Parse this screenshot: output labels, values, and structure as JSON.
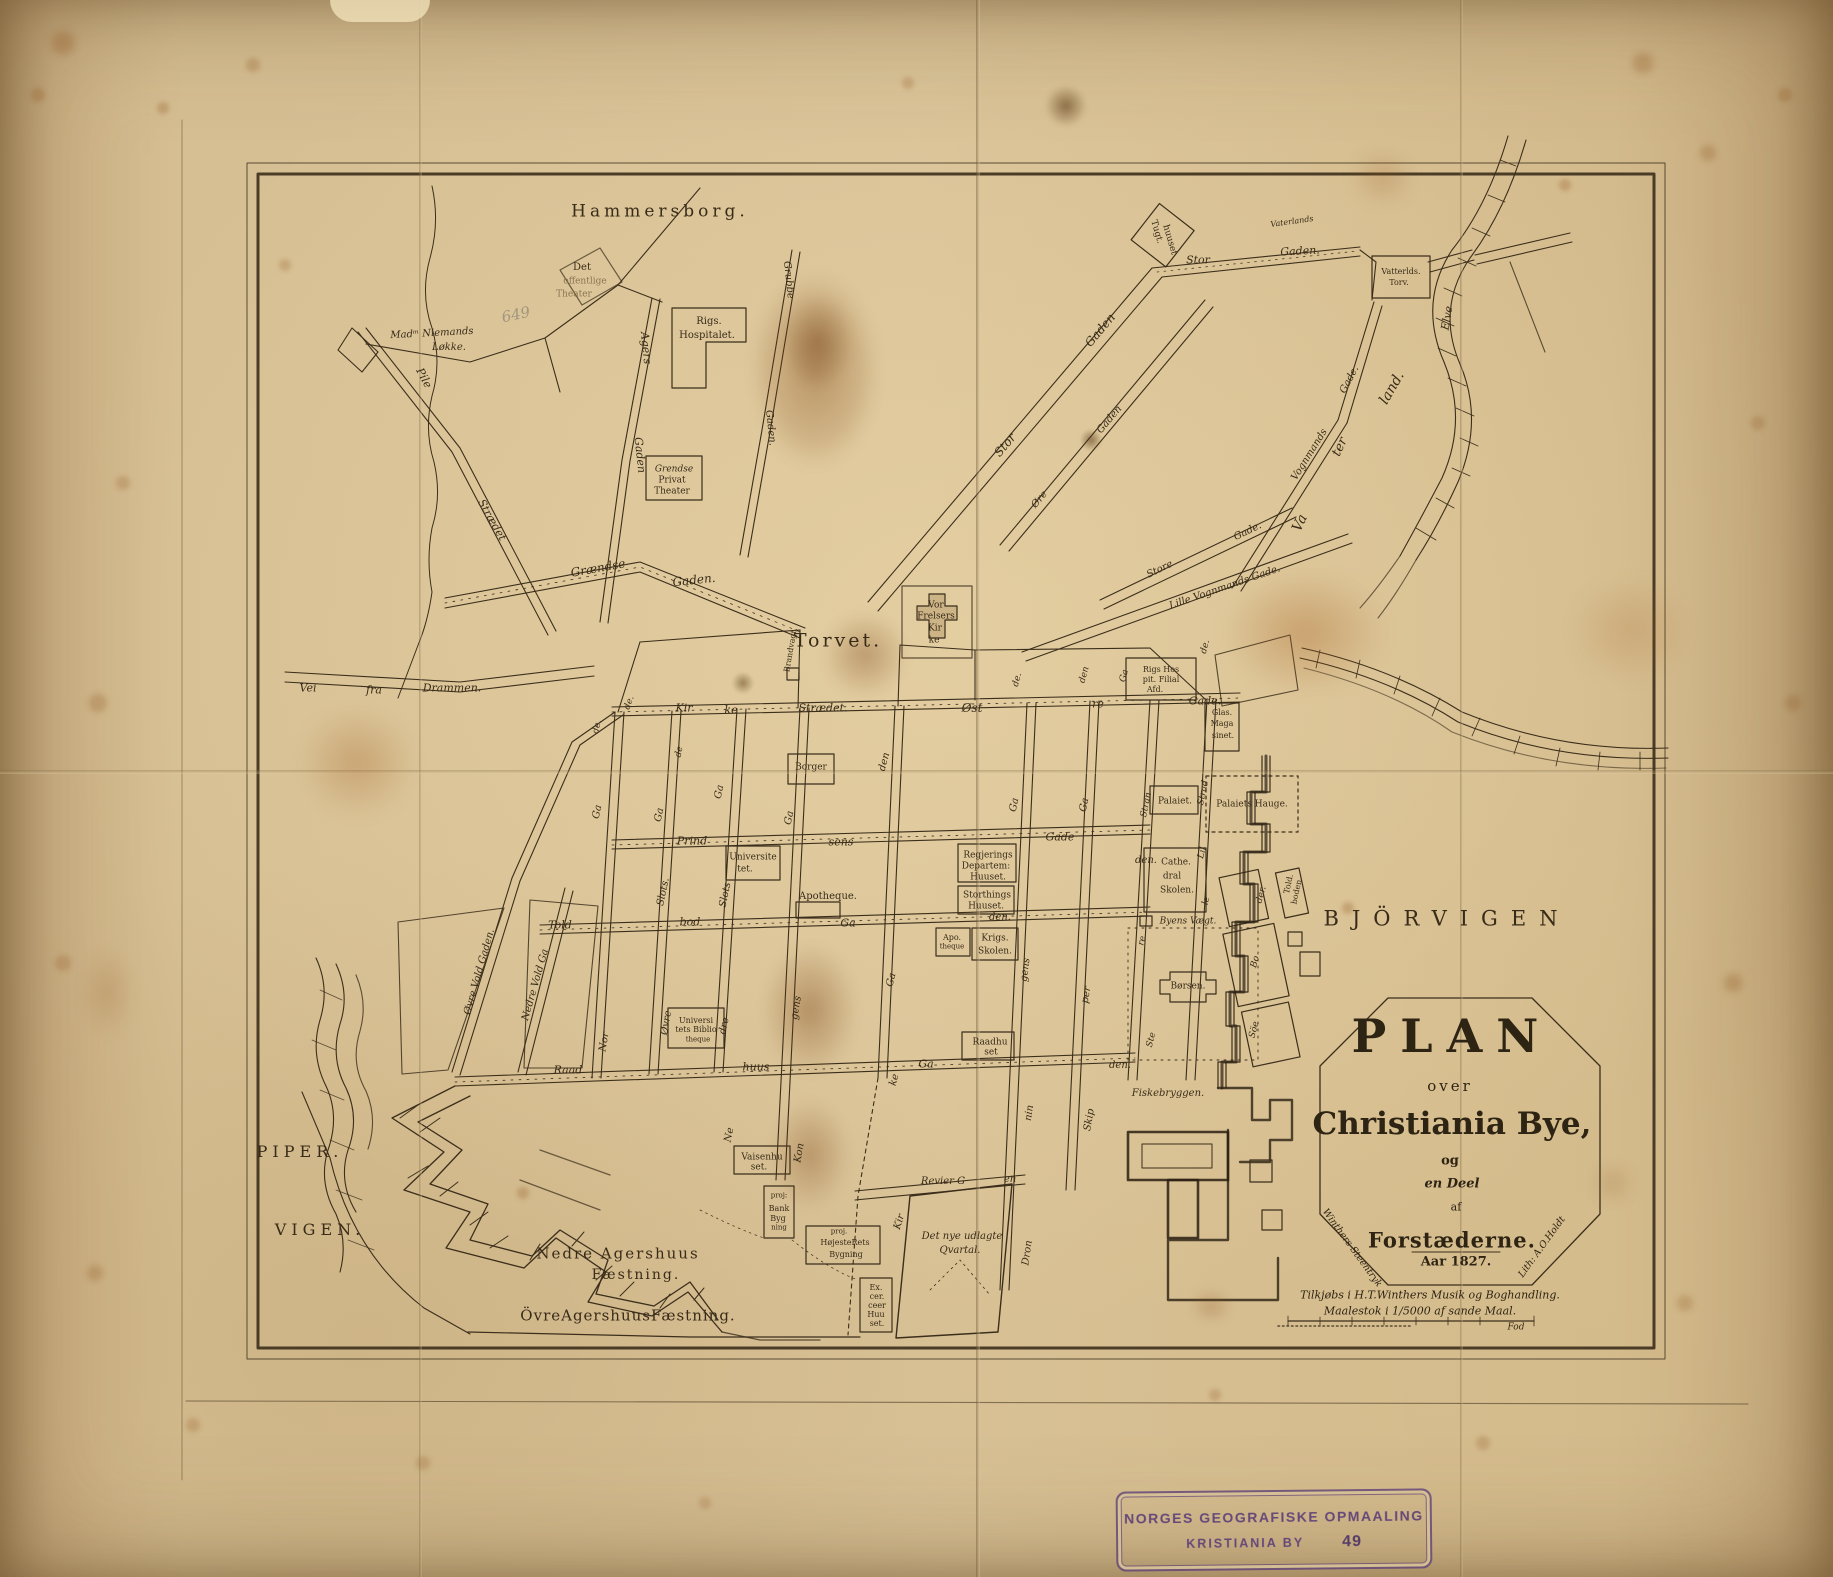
{
  "map_title": "Plan over Christiania Bye og en Deel af Forstæderne",
  "colors": {
    "ink": "#3b2e1b",
    "heavy_ink": "#2a2012",
    "label_ink": "#382b18",
    "stamp_purple": "#5d3f78",
    "parchment": "#d8c196",
    "stain_brown": "#8a5420"
  },
  "cartouche": {
    "plan": "PLAN",
    "over": "over",
    "city": "Christiania Bye,",
    "og": "og",
    "deel": "en Deel",
    "af": "af",
    "forstaederne": "Forstæderne.",
    "year": "Aar 1827.",
    "left_edge": "Winthers Steentryk",
    "right_edge": "Lith: A.O.Holdt"
  },
  "imprint": {
    "line1": "Tilkjøbs i H.T.Winthers Musik og Boghandling.",
    "line2": "Maalestok i 1/5000 af sande Maal.",
    "unit": "Fod"
  },
  "stamp": {
    "line1": "NORGES GEOGRAFISKE OPMAALING",
    "line2": "KRISTIANIA BY",
    "number": "49"
  },
  "labels": [
    {
      "t": "Hammersborg.",
      "x": 660,
      "y": 212,
      "s": 17,
      "ls": 4
    },
    {
      "t": "Torvet.",
      "x": 838,
      "y": 641,
      "s": 19,
      "ls": 3
    },
    {
      "t": "BJÖRVIGEN",
      "x": 1447,
      "y": 919,
      "s": 21,
      "ls": 13
    },
    {
      "t": "PIPER.",
      "x": 300,
      "y": 1152,
      "s": 16,
      "ls": 5
    },
    {
      "t": "VIGEN.",
      "x": 320,
      "y": 1230,
      "s": 16,
      "ls": 5
    },
    {
      "t": "Nedre Agershuus",
      "x": 618,
      "y": 1254,
      "s": 15,
      "ls": 2
    },
    {
      "t": "Fæstning.",
      "x": 636,
      "y": 1275,
      "s": 14,
      "ls": 2
    },
    {
      "t": "ÖvreAgershuusFæstning.",
      "x": 628,
      "y": 1316,
      "s": 15,
      "ls": 1
    },
    {
      "t": "Va",
      "x": 1300,
      "y": 523,
      "s": 14,
      "r": -65,
      "i": 1
    },
    {
      "t": "ter",
      "x": 1340,
      "y": 447,
      "s": 13,
      "r": -65,
      "i": 1
    },
    {
      "t": "land.",
      "x": 1392,
      "y": 388,
      "s": 14,
      "r": -60,
      "i": 1
    },
    {
      "t": "Elve",
      "x": 1447,
      "y": 318,
      "s": 11,
      "r": -80,
      "i": 1
    },
    {
      "t": "Det",
      "x": 582,
      "y": 268,
      "s": 10
    },
    {
      "t": "offentlige",
      "x": 585,
      "y": 282,
      "s": 9,
      "c": "faint"
    },
    {
      "t": "Theater",
      "x": 574,
      "y": 295,
      "s": 9,
      "c": "faint"
    },
    {
      "t": "Madᵐ Niemands",
      "x": 432,
      "y": 334,
      "s": 10,
      "i": 1,
      "r": -3
    },
    {
      "t": "Løkke.",
      "x": 449,
      "y": 348,
      "s": 10,
      "i": 1
    },
    {
      "t": "649",
      "x": 516,
      "y": 315,
      "s": 15,
      "r": -12,
      "c": "pencil"
    },
    {
      "t": "Pile",
      "x": 424,
      "y": 378,
      "s": 11,
      "i": 1,
      "r": 62
    },
    {
      "t": "Strædet",
      "x": 492,
      "y": 520,
      "s": 11,
      "i": 1,
      "r": 60
    },
    {
      "t": "Agers",
      "x": 646,
      "y": 348,
      "s": 11,
      "i": 1,
      "r": 84
    },
    {
      "t": "Gaden",
      "x": 640,
      "y": 455,
      "s": 11,
      "i": 1,
      "r": 84
    },
    {
      "t": "Grubbe",
      "x": 788,
      "y": 280,
      "s": 10,
      "i": 1,
      "r": 84
    },
    {
      "t": "Gaden.",
      "x": 770,
      "y": 428,
      "s": 10,
      "i": 1,
      "r": 84
    },
    {
      "t": "Rigs.",
      "x": 709,
      "y": 322,
      "s": 10
    },
    {
      "t": "Hospitalet.",
      "x": 707,
      "y": 336,
      "s": 10
    },
    {
      "t": "Grendse",
      "x": 674,
      "y": 470,
      "s": 9,
      "i": 1
    },
    {
      "t": "Privat",
      "x": 672,
      "y": 481,
      "s": 9
    },
    {
      "t": "Theater",
      "x": 672,
      "y": 492,
      "s": 9
    },
    {
      "t": "Grændse",
      "x": 598,
      "y": 568,
      "s": 12,
      "i": 1,
      "r": -10
    },
    {
      "t": "Gaden.",
      "x": 694,
      "y": 580,
      "s": 12,
      "i": 1,
      "r": -6
    },
    {
      "t": "Vei",
      "x": 308,
      "y": 688,
      "s": 11,
      "i": 1
    },
    {
      "t": "fra",
      "x": 374,
      "y": 690,
      "s": 11,
      "i": 1
    },
    {
      "t": "Drammen.",
      "x": 452,
      "y": 688,
      "s": 11,
      "i": 1
    },
    {
      "t": "Tugt.",
      "x": 1156,
      "y": 232,
      "s": 9,
      "r": 74
    },
    {
      "t": "huuset",
      "x": 1169,
      "y": 240,
      "s": 9,
      "r": 74
    },
    {
      "t": "Stor",
      "x": 1198,
      "y": 260,
      "s": 11,
      "i": 1
    },
    {
      "t": "Gaden.",
      "x": 1300,
      "y": 251,
      "s": 11,
      "i": 1,
      "r": -3
    },
    {
      "t": "Vaterlands",
      "x": 1292,
      "y": 222,
      "s": 8,
      "i": 1,
      "r": -8
    },
    {
      "t": "Vatterlds.",
      "x": 1401,
      "y": 272,
      "s": 8
    },
    {
      "t": "Torv.",
      "x": 1399,
      "y": 283,
      "s": 8
    },
    {
      "t": "Stor",
      "x": 1005,
      "y": 445,
      "s": 12,
      "i": 1,
      "r": -50
    },
    {
      "t": "Gaden",
      "x": 1100,
      "y": 330,
      "s": 12,
      "i": 1,
      "r": -50
    },
    {
      "t": "Øre",
      "x": 1040,
      "y": 500,
      "s": 10,
      "i": 1,
      "r": -50
    },
    {
      "t": "Gaden",
      "x": 1110,
      "y": 420,
      "s": 10,
      "i": 1,
      "r": -50
    },
    {
      "t": "Store",
      "x": 1160,
      "y": 570,
      "s": 10,
      "i": 1,
      "r": -26
    },
    {
      "t": "Gade.",
      "x": 1248,
      "y": 532,
      "s": 10,
      "i": 1,
      "r": -26
    },
    {
      "t": "Lille Vognmands Gade.",
      "x": 1225,
      "y": 588,
      "s": 10,
      "i": 1,
      "r": -19
    },
    {
      "t": "Vognmands",
      "x": 1310,
      "y": 455,
      "s": 10,
      "i": 1,
      "r": -58
    },
    {
      "t": "Gade.",
      "x": 1350,
      "y": 380,
      "s": 10,
      "i": 1,
      "r": -62
    },
    {
      "t": "de.",
      "x": 630,
      "y": 703,
      "s": 9,
      "i": 1,
      "r": -70
    },
    {
      "t": "Kir",
      "x": 684,
      "y": 708,
      "s": 11,
      "i": 1
    },
    {
      "t": "ke",
      "x": 731,
      "y": 710,
      "s": 11,
      "i": 1
    },
    {
      "t": "Strædet.",
      "x": 823,
      "y": 708,
      "s": 11,
      "i": 1
    },
    {
      "t": "Øst",
      "x": 972,
      "y": 708,
      "s": 12,
      "i": 1
    },
    {
      "t": "re",
      "x": 1098,
      "y": 704,
      "s": 11,
      "i": 1
    },
    {
      "t": "Gade.",
      "x": 1205,
      "y": 701,
      "s": 11,
      "i": 1
    },
    {
      "t": "Prind",
      "x": 692,
      "y": 841,
      "s": 11,
      "i": 1
    },
    {
      "t": "sens",
      "x": 841,
      "y": 842,
      "s": 11,
      "i": 1
    },
    {
      "t": "Gade",
      "x": 1060,
      "y": 837,
      "s": 11,
      "i": 1
    },
    {
      "t": "den.",
      "x": 1146,
      "y": 861,
      "s": 10,
      "i": 1
    },
    {
      "t": "Told",
      "x": 560,
      "y": 925,
      "s": 11,
      "i": 1
    },
    {
      "t": "bod",
      "x": 690,
      "y": 922,
      "s": 11,
      "i": 1
    },
    {
      "t": "Ga",
      "x": 848,
      "y": 923,
      "s": 11,
      "i": 1
    },
    {
      "t": "den.",
      "x": 1000,
      "y": 918,
      "s": 10,
      "i": 1
    },
    {
      "t": "Raad",
      "x": 568,
      "y": 1070,
      "s": 11,
      "i": 1
    },
    {
      "t": "huus",
      "x": 756,
      "y": 1067,
      "s": 11,
      "i": 1
    },
    {
      "t": "Ga",
      "x": 926,
      "y": 1064,
      "s": 11,
      "i": 1
    },
    {
      "t": "den.",
      "x": 1120,
      "y": 1066,
      "s": 10,
      "i": 1
    },
    {
      "t": "Revier G",
      "x": 943,
      "y": 1182,
      "s": 10,
      "i": 1
    },
    {
      "t": "en",
      "x": 1010,
      "y": 1180,
      "s": 10,
      "i": 1
    },
    {
      "t": "Øvre Vold Gaden.",
      "x": 480,
      "y": 972,
      "s": 10,
      "i": 1,
      "r": -74
    },
    {
      "t": "Nedre Vold Ga",
      "x": 536,
      "y": 985,
      "s": 10,
      "i": 1,
      "r": -74
    },
    {
      "t": "Nor",
      "x": 605,
      "y": 1042,
      "s": 10,
      "i": 1,
      "r": -80
    },
    {
      "t": "Øvre",
      "x": 667,
      "y": 1023,
      "s": 10,
      "i": 1,
      "r": -80
    },
    {
      "t": "Slots.",
      "x": 664,
      "y": 892,
      "s": 10,
      "i": 1,
      "r": -78
    },
    {
      "t": "Ga",
      "x": 660,
      "y": 815,
      "s": 10,
      "i": 1,
      "r": -78
    },
    {
      "t": "de.",
      "x": 598,
      "y": 727,
      "s": 9,
      "i": 1,
      "r": -76
    },
    {
      "t": "Ga",
      "x": 598,
      "y": 812,
      "s": 10,
      "i": 1,
      "r": -78
    },
    {
      "t": "de",
      "x": 680,
      "y": 752,
      "s": 9,
      "i": 1,
      "r": -78
    },
    {
      "t": "Ne",
      "x": 730,
      "y": 1135,
      "s": 10,
      "i": 1,
      "r": -78
    },
    {
      "t": "dre",
      "x": 725,
      "y": 1026,
      "s": 10,
      "i": 1,
      "r": -78
    },
    {
      "t": "Slots",
      "x": 726,
      "y": 895,
      "s": 10,
      "i": 1,
      "r": -78
    },
    {
      "t": "Ga",
      "x": 720,
      "y": 792,
      "s": 10,
      "i": 1,
      "r": -78
    },
    {
      "t": "Kon",
      "x": 800,
      "y": 1153,
      "s": 10,
      "i": 1,
      "r": -80
    },
    {
      "t": "gens",
      "x": 797,
      "y": 1008,
      "s": 10,
      "i": 1,
      "r": -80
    },
    {
      "t": "Ga",
      "x": 790,
      "y": 818,
      "s": 10,
      "i": 1,
      "r": -78
    },
    {
      "t": "Kir",
      "x": 900,
      "y": 1222,
      "s": 10,
      "i": 1,
      "r": -72
    },
    {
      "t": "ke",
      "x": 895,
      "y": 1080,
      "s": 10,
      "i": 1,
      "r": -75
    },
    {
      "t": "Ga",
      "x": 892,
      "y": 980,
      "s": 10,
      "i": 1,
      "r": -76
    },
    {
      "t": "den",
      "x": 885,
      "y": 762,
      "s": 10,
      "i": 1,
      "r": -75
    },
    {
      "t": "Dron",
      "x": 1028,
      "y": 1253,
      "s": 10,
      "i": 1,
      "r": -82
    },
    {
      "t": "nin",
      "x": 1030,
      "y": 1113,
      "s": 10,
      "i": 1,
      "r": -82
    },
    {
      "t": "gens",
      "x": 1026,
      "y": 970,
      "s": 10,
      "i": 1,
      "r": -82
    },
    {
      "t": "Ga",
      "x": 1015,
      "y": 805,
      "s": 10,
      "i": 1,
      "r": -78
    },
    {
      "t": "Skip",
      "x": 1090,
      "y": 1120,
      "s": 10,
      "i": 1,
      "r": -80
    },
    {
      "t": "per",
      "x": 1087,
      "y": 995,
      "s": 10,
      "i": 1,
      "r": -80
    },
    {
      "t": "Ga",
      "x": 1085,
      "y": 805,
      "s": 10,
      "i": 1,
      "r": -78
    },
    {
      "t": "Ste",
      "x": 1152,
      "y": 1040,
      "s": 9,
      "i": 1,
      "r": -76
    },
    {
      "t": "re",
      "x": 1143,
      "y": 941,
      "s": 9,
      "i": 1,
      "r": -76
    },
    {
      "t": "Stran",
      "x": 1147,
      "y": 805,
      "s": 9,
      "i": 1,
      "r": -78
    },
    {
      "t": "Strad",
      "x": 1204,
      "y": 793,
      "s": 9,
      "i": 1,
      "r": -78
    },
    {
      "t": "Lil",
      "x": 1203,
      "y": 853,
      "s": 9,
      "i": 1,
      "r": -75
    },
    {
      "t": "le",
      "x": 1207,
      "y": 901,
      "s": 9,
      "i": 1,
      "r": -75
    },
    {
      "t": "de.",
      "x": 1018,
      "y": 680,
      "s": 9,
      "i": 1,
      "r": -75
    },
    {
      "t": "den",
      "x": 1085,
      "y": 675,
      "s": 9,
      "i": 1,
      "r": -75
    },
    {
      "t": "Ga",
      "x": 1125,
      "y": 676,
      "s": 9,
      "i": 1,
      "r": -75
    },
    {
      "t": "de.",
      "x": 1206,
      "y": 647,
      "s": 9,
      "i": 1,
      "r": -75
    },
    {
      "t": "Vor",
      "x": 936,
      "y": 606,
      "s": 9
    },
    {
      "t": "Frelsers",
      "x": 936,
      "y": 617,
      "s": 9
    },
    {
      "t": "Kir",
      "x": 935,
      "y": 629,
      "s": 9
    },
    {
      "t": "ke",
      "x": 934,
      "y": 641,
      "s": 9
    },
    {
      "t": "Brandvagt.",
      "x": 791,
      "y": 650,
      "s": 8,
      "r": -80
    },
    {
      "t": "Borger",
      "x": 811,
      "y": 768,
      "s": 9
    },
    {
      "t": "Universite",
      "x": 753,
      "y": 858,
      "s": 9
    },
    {
      "t": "tet.",
      "x": 745,
      "y": 870,
      "s": 9
    },
    {
      "t": "Apotheque.",
      "x": 828,
      "y": 897,
      "s": 10
    },
    {
      "t": "Regjerings",
      "x": 988,
      "y": 856,
      "s": 9
    },
    {
      "t": "Departem:",
      "x": 986,
      "y": 867,
      "s": 9
    },
    {
      "t": "Huuset.",
      "x": 988,
      "y": 878,
      "s": 9
    },
    {
      "t": "Storthings",
      "x": 987,
      "y": 896,
      "s": 9
    },
    {
      "t": "Huuset.",
      "x": 986,
      "y": 907,
      "s": 9
    },
    {
      "t": "Apo.",
      "x": 952,
      "y": 938,
      "s": 8
    },
    {
      "t": "theque",
      "x": 952,
      "y": 947,
      "s": 7
    },
    {
      "t": "Krigs.",
      "x": 995,
      "y": 939,
      "s": 9
    },
    {
      "t": "Skolen.",
      "x": 995,
      "y": 952,
      "s": 9
    },
    {
      "t": "Cathe.",
      "x": 1176,
      "y": 863,
      "s": 9
    },
    {
      "t": "dral",
      "x": 1172,
      "y": 877,
      "s": 9
    },
    {
      "t": "Skolen.",
      "x": 1177,
      "y": 891,
      "s": 9
    },
    {
      "t": "Byens Vægt.",
      "x": 1188,
      "y": 922,
      "s": 9,
      "i": 1
    },
    {
      "t": "Børsen.",
      "x": 1188,
      "y": 987,
      "s": 9
    },
    {
      "t": "Palaiet.",
      "x": 1175,
      "y": 802,
      "s": 9
    },
    {
      "t": "Palaiets Hauge.",
      "x": 1252,
      "y": 805,
      "s": 9
    },
    {
      "t": "Rigs Hos",
      "x": 1161,
      "y": 670,
      "s": 8
    },
    {
      "t": "pit. Filial",
      "x": 1161,
      "y": 680,
      "s": 8
    },
    {
      "t": "Afd.",
      "x": 1155,
      "y": 690,
      "s": 8
    },
    {
      "t": "Glas.",
      "x": 1222,
      "y": 713,
      "s": 8
    },
    {
      "t": "Maga",
      "x": 1222,
      "y": 724,
      "s": 8
    },
    {
      "t": "sinet.",
      "x": 1223,
      "y": 736,
      "s": 8
    },
    {
      "t": "Told.",
      "x": 1289,
      "y": 884,
      "s": 8,
      "r": -78
    },
    {
      "t": "boden",
      "x": 1297,
      "y": 892,
      "s": 8,
      "r": -78
    },
    {
      "t": "der.",
      "x": 1262,
      "y": 895,
      "s": 9,
      "i": 1,
      "r": -75
    },
    {
      "t": "Bo",
      "x": 1256,
      "y": 962,
      "s": 9,
      "i": 1,
      "r": -75
    },
    {
      "t": "Söe",
      "x": 1255,
      "y": 1030,
      "s": 9,
      "i": 1,
      "r": -75
    },
    {
      "t": "Universi",
      "x": 696,
      "y": 1021,
      "s": 8
    },
    {
      "t": "tets Biblio",
      "x": 696,
      "y": 1030,
      "s": 8
    },
    {
      "t": "theque",
      "x": 698,
      "y": 1040,
      "s": 7
    },
    {
      "t": "Raadhu",
      "x": 990,
      "y": 1043,
      "s": 9
    },
    {
      "t": "set",
      "x": 991,
      "y": 1053,
      "s": 9
    },
    {
      "t": "Vaisenhu",
      "x": 762,
      "y": 1158,
      "s": 9
    },
    {
      "t": "set.",
      "x": 759,
      "y": 1168,
      "s": 9
    },
    {
      "t": "Fiskebryggen.",
      "x": 1168,
      "y": 1094,
      "s": 10,
      "i": 1
    },
    {
      "t": "proj:",
      "x": 779,
      "y": 1196,
      "s": 7
    },
    {
      "t": "Bank",
      "x": 779,
      "y": 1209,
      "s": 8
    },
    {
      "t": "Byg",
      "x": 778,
      "y": 1219,
      "s": 8
    },
    {
      "t": "ning",
      "x": 779,
      "y": 1228,
      "s": 7
    },
    {
      "t": "proj.",
      "x": 839,
      "y": 1232,
      "s": 7
    },
    {
      "t": "HøjesteRets",
      "x": 845,
      "y": 1243,
      "s": 8
    },
    {
      "t": "Bygning",
      "x": 846,
      "y": 1255,
      "s": 8
    },
    {
      "t": "Ex.",
      "x": 876,
      "y": 1288,
      "s": 8
    },
    {
      "t": "cer.",
      "x": 877,
      "y": 1297,
      "s": 8
    },
    {
      "t": "ceer",
      "x": 877,
      "y": 1306,
      "s": 8
    },
    {
      "t": "Huu",
      "x": 876,
      "y": 1315,
      "s": 8
    },
    {
      "t": "set.",
      "x": 877,
      "y": 1324,
      "s": 8
    },
    {
      "t": "Det nye udlagte",
      "x": 962,
      "y": 1237,
      "s": 10,
      "i": 1
    },
    {
      "t": "Qvartal.",
      "x": 960,
      "y": 1251,
      "s": 10,
      "i": 1
    },
    {
      "t": "Fod",
      "x": 1516,
      "y": 1328,
      "s": 9,
      "i": 1
    }
  ]
}
